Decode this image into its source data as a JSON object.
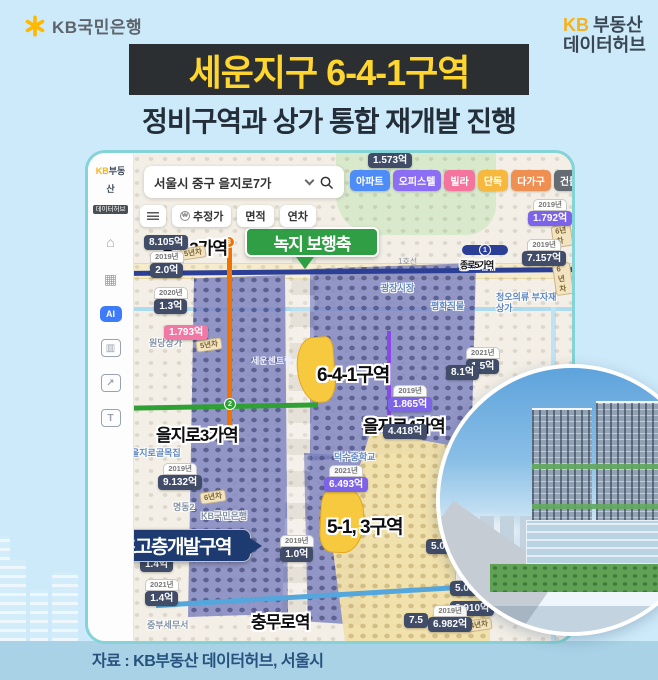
{
  "header": {
    "bank_brand": "KB국민은행",
    "hub_kb": "KB",
    "hub_line1": "부동산",
    "hub_line2": "데이터허브",
    "title": "세운지구 6-4-1구역",
    "subtitle": "정비구역과 상가 통합 재개발 진행"
  },
  "map": {
    "sidebar": {
      "logo_kb": "KB",
      "logo_name": "부동산",
      "logo_sub": "데이터허브",
      "icons": [
        {
          "name": "store-icon",
          "glyph": "⌂"
        },
        {
          "name": "buildings-icon",
          "glyph": "▦"
        },
        {
          "name": "ai-badge",
          "glyph": "AI"
        },
        {
          "name": "bar-chart-icon",
          "glyph": "▥"
        },
        {
          "name": "trend-icon",
          "glyph": "↗"
        },
        {
          "name": "land-icon",
          "glyph": "T"
        }
      ]
    },
    "search": {
      "value": "서울시 중구 을지로7가"
    },
    "categories": [
      {
        "label": "아파트",
        "color": "#4e8cf7"
      },
      {
        "label": "오피스텔",
        "color": "#8b6ef3"
      },
      {
        "label": "빌라",
        "color": "#f5749e"
      },
      {
        "label": "단독",
        "color": "#f6b93d"
      },
      {
        "label": "다가구",
        "color": "#ef8f52"
      },
      {
        "label": "건물",
        "color": "#646b72"
      },
      {
        "label": "토지",
        "color": "#e3e6e9"
      }
    ],
    "filters": [
      "추정가",
      "면적",
      "연차"
    ],
    "line1_label": "1호선",
    "line_bullets": {
      "line1": "1",
      "line2": "2",
      "line3": "3"
    },
    "stations": {
      "jongro3": "종로3가역",
      "jongro5": "종로5가역",
      "euljiro3": "을지로3가역",
      "euljiro4": "을지로4가역",
      "chungmuro": "충무로역"
    },
    "annotations": {
      "green_axis": "녹지 보행축",
      "zone_641": "6-4-1구역",
      "zone_513": "5-1, 3구역",
      "highrise": "초고층개발구역"
    },
    "places": [
      "원당상가",
      "을지로골목집",
      "명동2",
      "KB국민은행",
      "광장시장",
      "평화직물",
      "청오의류 부자재상가",
      "덕수중학교",
      "중부세무서",
      "세운센트럴"
    ],
    "prices": [
      {
        "year": "",
        "value": "1.573억"
      },
      {
        "year": "",
        "value": "8.105억"
      },
      {
        "year": "2019년",
        "value": "2.0억"
      },
      {
        "year": "2020년",
        "value": "1.3억"
      },
      {
        "year": "",
        "value": "1.793억"
      },
      {
        "year": "2019년",
        "value": "9.132억"
      },
      {
        "year": "2019년",
        "value": "1.792억"
      },
      {
        "year": "2019년",
        "value": "7.157억"
      },
      {
        "year": "2021년",
        "value": "1.5억"
      },
      {
        "year": "",
        "value": "8.1억"
      },
      {
        "year": "2019년",
        "value": "1.865억"
      },
      {
        "year": "",
        "value": "4.418억"
      },
      {
        "year": "2021년",
        "value": "6.493억"
      },
      {
        "year": "",
        "value": "5.012억"
      },
      {
        "year": "2019년",
        "value": "5.053억"
      },
      {
        "year": "",
        "value": "2.910억"
      },
      {
        "year": "",
        "value": "1.4억"
      },
      {
        "year": "2021년",
        "value": "1.4억"
      },
      {
        "year": "2019년",
        "value": "1.0억"
      },
      {
        "year": "2019년",
        "value": "6.982억"
      },
      {
        "year": "",
        "value": "7.5"
      }
    ],
    "year_chips": [
      "5년차",
      "6년차",
      "5년차",
      "6년차",
      "4년차",
      "6년차"
    ]
  },
  "footer": {
    "source": "자료 : KB부동산 데이터허브, 서울시"
  }
}
